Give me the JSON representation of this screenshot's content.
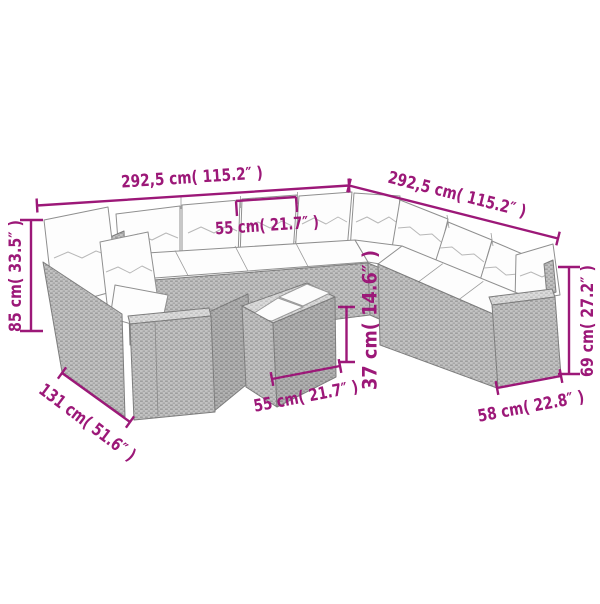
{
  "canvas": {
    "width": 600,
    "height": 600,
    "background": "#ffffff"
  },
  "colors": {
    "dimension_accent": "#9C1878",
    "outline_gray": "#7d7d7d",
    "wicker_gray": "#c2c2c2",
    "cushion_white": "#fdfdfd"
  },
  "illustration": {
    "description": "U-shaped modular poly rattan garden lounge set with white seat and back cushions and a square rattan coffee table with two trays, drawn in outline style with dimension callouts"
  },
  "dims": {
    "back_width": {
      "label": "292,5 cm( 115.2″ )"
    },
    "right_width": {
      "label": "292,5 cm( 115.2″ )"
    },
    "module_width": {
      "label": "55 cm( 21.7″ )"
    },
    "back_height": {
      "label": "85 cm( 33.5″ )"
    },
    "wing_depth": {
      "label": "131 cm( 51.6″ )"
    },
    "table_width": {
      "label": "55 cm( 21.7″ )"
    },
    "table_height": {
      "label": "37 cm( 14.6″ )"
    },
    "armrest_height": {
      "label": "69 cm( 27.2″ )"
    },
    "armrest_depth": {
      "label": "58 cm( 22.8″ )"
    }
  }
}
